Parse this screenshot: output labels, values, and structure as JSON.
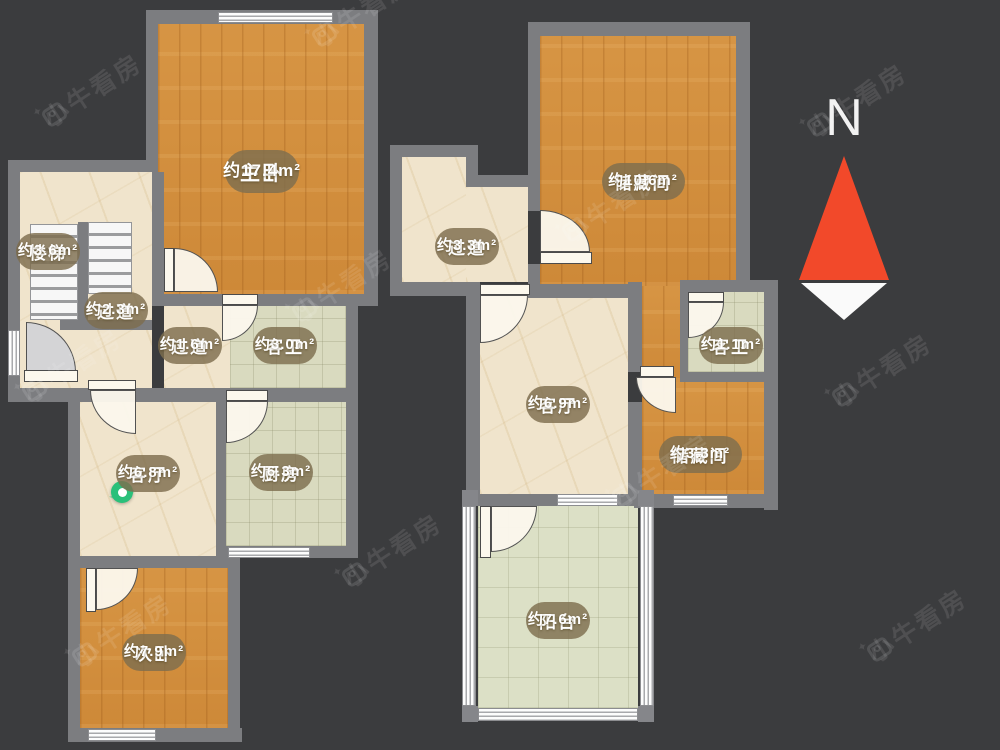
{
  "canvas": {
    "background": "#3b3c3e"
  },
  "watermark": {
    "text": "小牛看房",
    "sparkle": "✦"
  },
  "compass": {
    "label": "N",
    "arrow_red": "#f2492a",
    "arrow_white": "#fafafa"
  },
  "colors": {
    "wall": "#7c7d80",
    "wood_floor": "#d28f3e",
    "marble_floor": "#f0e4cc",
    "tile_floor": "#d9dabf",
    "balcony_floor": "#dce0c6",
    "label_pill": "rgba(126,110,78,0.82)",
    "marker_green": "#2ac07a"
  },
  "plans": {
    "left": {
      "rooms": [
        {
          "id": "master-bedroom",
          "name": "主卧",
          "area": "约17.4m²"
        },
        {
          "id": "stairs",
          "name": "楼梯",
          "area": "约3.6m²"
        },
        {
          "id": "hallway-a",
          "name": "过道",
          "area": "约2.3m²"
        },
        {
          "id": "hallway-b",
          "name": "过道",
          "area": "约1.6m²"
        },
        {
          "id": "guest-bathroom",
          "name": "客卫",
          "area": "约3.0m²"
        },
        {
          "id": "living-room",
          "name": "客厅",
          "area": "约6.8m²"
        },
        {
          "id": "kitchen",
          "name": "厨房",
          "area": "约6.3m²"
        },
        {
          "id": "second-bedroom",
          "name": "次卧",
          "area": "约7.9m²"
        }
      ]
    },
    "right": {
      "rooms": [
        {
          "id": "hallway",
          "name": "过道",
          "area": "约3.3m²"
        },
        {
          "id": "storage-room-large",
          "name": "储藏间",
          "area": "约10.6m²"
        },
        {
          "id": "guest-bathroom",
          "name": "客卫",
          "area": "约1.1m²"
        },
        {
          "id": "living-room",
          "name": "客厅",
          "area": "约6.9m²"
        },
        {
          "id": "storage-room-small",
          "name": "储藏间",
          "area": "约3.3m²"
        },
        {
          "id": "balcony",
          "name": "阳台",
          "area": "约7.6m²"
        }
      ]
    }
  }
}
